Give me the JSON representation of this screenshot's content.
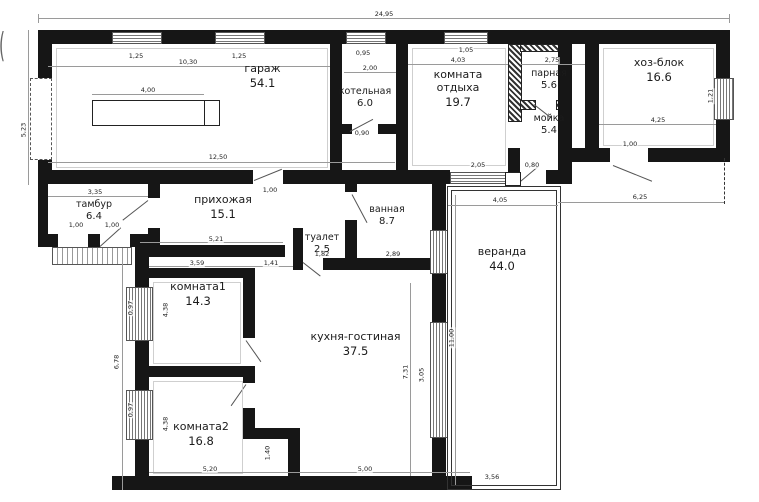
{
  "meta": {
    "drawing_type": "floor-plan",
    "background_color": "#ffffff",
    "wall_color": "#161616",
    "total_area_units": "m2"
  },
  "rooms": {
    "garage": {
      "name": "гараж",
      "area": "54.1"
    },
    "boiler": {
      "name": "котельная",
      "area": "6.0"
    },
    "rest": {
      "name": "комната отдыха",
      "area": "19.7"
    },
    "parnaya": {
      "name": "парная",
      "area": "5.6"
    },
    "moika": {
      "name": "мойка",
      "area": "5.4"
    },
    "hozblok": {
      "name": "хоз-блок",
      "area": "16.6"
    },
    "tambur": {
      "name": "тамбур",
      "area": "6.4"
    },
    "prihozhaya": {
      "name": "прихожая",
      "area": "15.1"
    },
    "tualet": {
      "name": "туалет",
      "area": "2.5"
    },
    "vannaya": {
      "name": "ванная",
      "area": "8.7"
    },
    "veranda": {
      "name": "веранда",
      "area": "44.0"
    },
    "komnata1": {
      "name": "комната1",
      "area": "14.3"
    },
    "kuhnya": {
      "name": "кухня-гостиная",
      "area": "37.5"
    },
    "komnata2": {
      "name": "комната2",
      "area": "16.8"
    }
  },
  "dims": [
    "24,95",
    "1,25",
    "1,25",
    "0,95",
    "1,05",
    "10,30",
    "4,00",
    "12,50",
    "5,23",
    "4,03",
    "2,75",
    "2,00",
    "0,90",
    "4,25",
    "1,00",
    "3,35",
    "1,00",
    "1,00",
    "1,00",
    "5,21",
    "2,05",
    "0,80",
    "2,89",
    "1,82",
    "3,59",
    "1,41",
    "4,38",
    "4,38",
    "5,20",
    "5,00",
    "3,56",
    "1,40",
    "4,05",
    "6,25",
    "11,00",
    "7,31",
    "3,05",
    "6,78",
    "0,97",
    "0,97",
    "1,21"
  ]
}
